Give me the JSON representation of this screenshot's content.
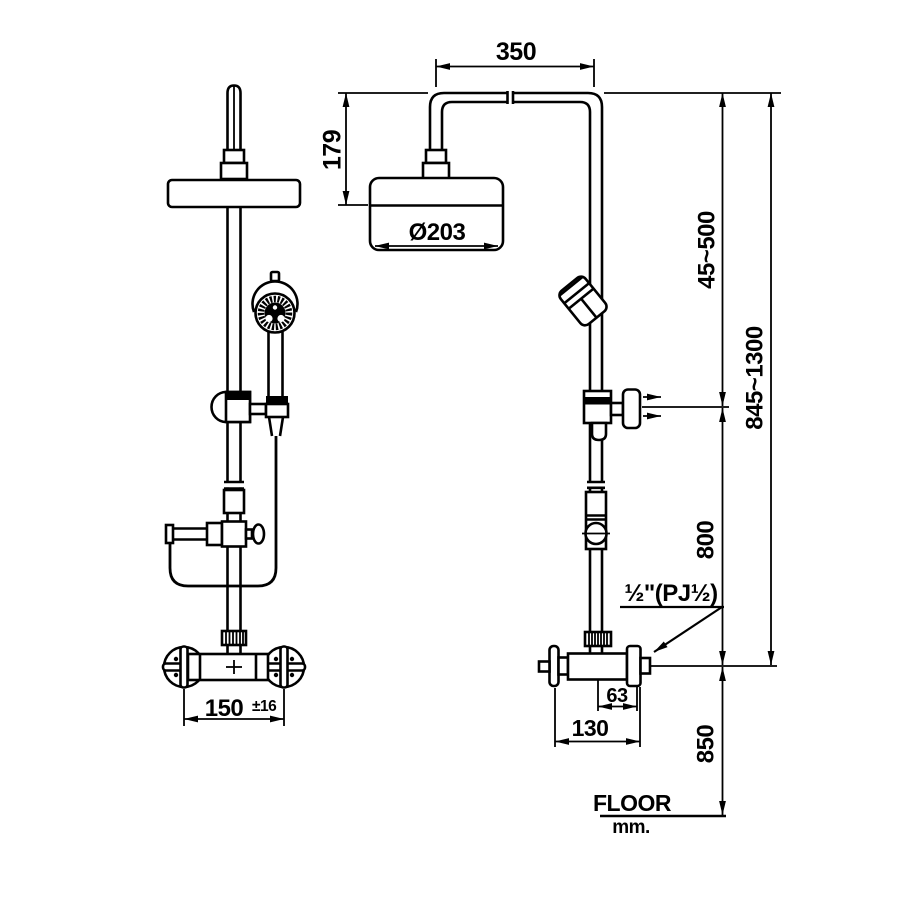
{
  "drawing": {
    "title": "shower-column-dimension-drawing",
    "colors": {
      "line": "#000000",
      "background": "#ffffff"
    },
    "dimensions": {
      "arm_span": "350",
      "head_drop": "179",
      "head_diameter": "Ø203",
      "slider_range": "45~500",
      "overall_height": "845~1300",
      "rail_length": "800",
      "inlet_height": "850",
      "wall_offset": "63",
      "valve_depth": "130",
      "inlet_spacing_value": "150",
      "inlet_spacing_tolerance": "±16",
      "thread_label": "½\"(PJ½)"
    },
    "footer": {
      "floor_label": "FLOOR",
      "unit_label": "mm."
    }
  }
}
